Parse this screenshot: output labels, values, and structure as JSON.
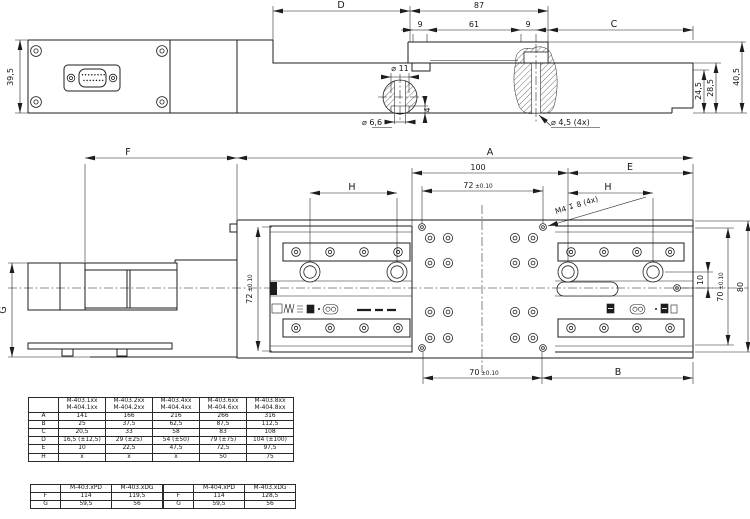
{
  "side_view": {
    "dims": {
      "d": "D",
      "total": "87",
      "seg_left": "9",
      "seg_mid": "61",
      "seg_right": "9",
      "c": "C",
      "dia11": "⌀ 11",
      "dia66": "⌀ 6,6",
      "depth4": "4",
      "dia45": "⌀ 4,5 (4x)",
      "height": "39,5",
      "h24": "24,5",
      "h28": "28,5",
      "h40": "40,5"
    }
  },
  "plan_view": {
    "dims": {
      "f": "F",
      "a": "A",
      "n100": "100",
      "t72_top": {
        "v": "72",
        "tol": "±0.10"
      },
      "h_left": "H",
      "e": "E",
      "h_right": "H",
      "thread": "M4 ↧ 8 (4x)",
      "t72_left": {
        "v": "72",
        "tol": "±0.10"
      },
      "n10": "10",
      "t70_right": {
        "v": "70",
        "tol": "±0.10"
      },
      "n80": "80",
      "g": "G",
      "t70_bottom": {
        "v": "70",
        "tol": "±0.10"
      },
      "b": "B"
    }
  },
  "tables": {
    "models": {
      "col_headers": [
        [
          "M-403.1xx",
          "M-404.1xx"
        ],
        [
          "M-403.2xx",
          "M-404.2xx"
        ],
        [
          "M-403.4xx",
          "M-404.4xx"
        ],
        [
          "M-403.6xx",
          "M-404.6xx"
        ],
        [
          "M-403.8xx",
          "M-404.8xx"
        ]
      ],
      "rows": [
        {
          "label": "A",
          "values": [
            "141",
            "166",
            "216",
            "266",
            "316"
          ]
        },
        {
          "label": "B",
          "values": [
            "25",
            "37,5",
            "62,5",
            "87,5",
            "112,5"
          ]
        },
        {
          "label": "C",
          "values": [
            "20,5",
            "33",
            "58",
            "83",
            "108"
          ]
        },
        {
          "label": "D",
          "values": [
            "16,5 (±12,5)",
            "29 (±25)",
            "54 (±50)",
            "79 (±75)",
            "104 (±100)"
          ]
        },
        {
          "label": "E",
          "values": [
            "10",
            "22,5",
            "47,5",
            "72,5",
            "97,5"
          ]
        },
        {
          "label": "H",
          "values": [
            "x",
            "x",
            "x",
            "50",
            "75"
          ]
        }
      ]
    },
    "variant_left": {
      "col_headers": [
        "M-403.xPD",
        "M-403.xDG"
      ],
      "rows": [
        {
          "label": "F",
          "values": [
            "114",
            "119,5"
          ]
        },
        {
          "label": "G",
          "values": [
            "59,5",
            "56"
          ]
        }
      ]
    },
    "variant_right": {
      "col_headers": [
        "M-404.xPD",
        "M-403.xDG"
      ],
      "rows": [
        {
          "label": "F",
          "values": [
            "114",
            "128,5"
          ]
        },
        {
          "label": "G",
          "values": [
            "59,5",
            "56"
          ]
        }
      ]
    }
  }
}
